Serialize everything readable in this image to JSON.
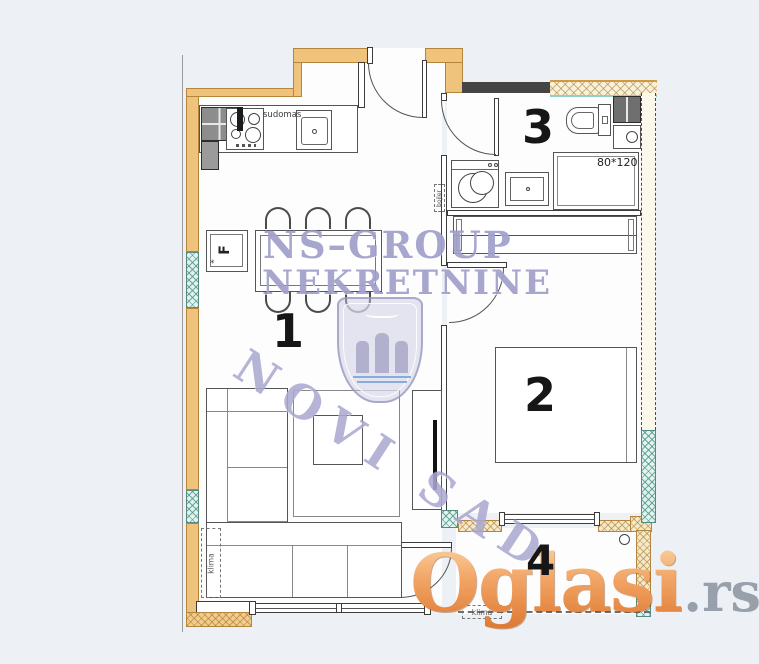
{
  "watermark": {
    "brand_line1": "NS–GROUP",
    "brand_line2": "NEKRETNINE",
    "city": "NOVI SAD",
    "color": "#9896c6"
  },
  "logo": {
    "text": "Oglasi",
    "suffix": ".rs",
    "text_color": "#e8853d",
    "suffix_color": "#98a0ab"
  },
  "rooms": {
    "living": "1",
    "bedroom": "2",
    "bathroom": "3",
    "terrace": "4"
  },
  "labels": {
    "dishwasher": "sudomas",
    "fridge": "F",
    "shower_size": "80*120",
    "ac_living": "klima",
    "ac_terrace": "klima",
    "boiler": "bojler"
  },
  "palette": {
    "wall": "#f0c37c",
    "window": "#cfe8e0",
    "background": "#edf0f4"
  }
}
